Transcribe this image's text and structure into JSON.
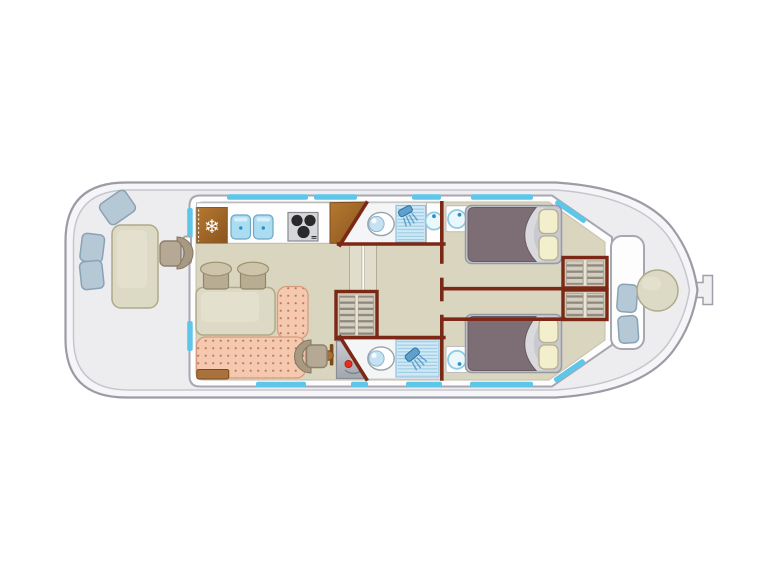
{
  "icons": {
    "snowflake": "❄"
  },
  "colors": {
    "page_bg": "#ffffff",
    "hull_fill": "#f6f6f8",
    "hull_stroke": "#9b9ca6",
    "deck_fill": "#ededf0",
    "deck_stroke": "#c6c6ce",
    "cabin_wall_fill": "#fdfdfe",
    "cabin_wall_stroke": "#a7a7b1",
    "floor_fill": "#d9d5bf",
    "floor_stroke": "#c4c0ab",
    "interior_wall": "#7b2817",
    "window_blue": "#5ec6e9",
    "wood_brown": "#a9713c",
    "wood_brown_dark": "#7b4a1c",
    "counter_white": "#fefefe",
    "sink_blue": "#aadcf2",
    "water_blue_light": "#cfe9f6",
    "water_line": "#8fc2de",
    "fixture_blue": "#5fa0cc",
    "basin_ring": "#8fcbe4",
    "basin_dot": "#2f8fc0",
    "stove_gray": "#d6d7d9",
    "burner_black": "#2a2a2e",
    "sofa_pink": "#f4c9b0",
    "sofa_dot": "#c27a55",
    "sofa_stroke": "#d79c7e",
    "table_beige": "#dcd9c4",
    "table_stroke": "#aeaa8a",
    "stool_taupe": "#b8ad92",
    "seat_taupe": "#b5a894",
    "deck_seat_blue": "#b5c8d6",
    "deck_seat_stroke": "#8aa2b4",
    "bed_mauve": "#7d6e76",
    "mattress_gray": "#c9c9cf",
    "pillow_cream": "#f3eecb",
    "slat_light": "#d4cec0",
    "slat_dark": "#8e897c",
    "panel_gray": "#b9bcc2",
    "led_red": "#e23020",
    "led_green": "#8ec73a",
    "toilet_blue": "#c6e2f2"
  },
  "plan": {
    "view": "top-down boat floor plan, bow pointing right",
    "aft_deck": {
      "items": [
        "rectangular table",
        "deck seat",
        "deck seat",
        "deck seat",
        "helm seat"
      ]
    },
    "galley": {
      "items": [
        "refrigerator with snowflake symbol",
        "double sink",
        "stove with three burners",
        "wooden worktop"
      ]
    },
    "saloon": {
      "items": [
        "dinette table",
        "stool",
        "stool",
        "l-shaped dotted sofa",
        "armchair",
        "slatted wardrobe",
        "electrical panel with red and green indicators",
        "companionway steps",
        "door knob"
      ]
    },
    "bathroom_top": {
      "items": [
        "toilet",
        "shower tray",
        "washbasin"
      ]
    },
    "bathroom_bottom": {
      "items": [
        "toilet",
        "shower tray"
      ]
    },
    "cabin_top": {
      "items": [
        "double bed with mauve duvet",
        "two cream pillows",
        "washbasin",
        "slatted wardrobe"
      ]
    },
    "cabin_bottom": {
      "items": [
        "double bed with mauve duvet",
        "two cream pillows",
        "washbasin",
        "slatted wardrobe"
      ]
    },
    "bow_deck": {
      "items": [
        "round table",
        "deck seat",
        "deck seat",
        "bow fitting",
        "bench locker"
      ]
    }
  }
}
